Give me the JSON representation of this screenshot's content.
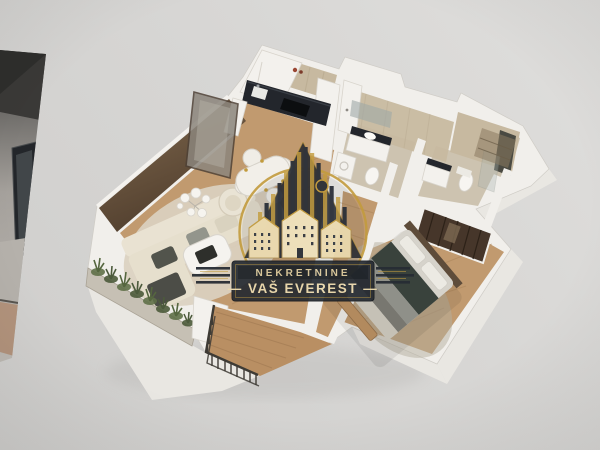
{
  "watermark": {
    "line1": "NEKRETNINE",
    "line2": "— VAŠ EVEREST —"
  },
  "scene_icons": {
    "floor_plan": "isometric-apartment-floorplan",
    "logo": "buildings-emblem-in-gold-ring"
  },
  "colors": {
    "bg_dark": "#cfcecc",
    "bg_light": "#dedddb",
    "wall": "#f1efeb",
    "wall_face": "#e9e7e2",
    "wall_shade": "#d8d5cf",
    "wood": "#c19a6f",
    "wood_dark": "#b08a5e",
    "plank": "#a37c52",
    "rug": "#dbd1c0",
    "tile_floor": "#cdc3b0",
    "tile_wall": "#c7b9a0",
    "counter_dark": "#23262c",
    "accent_wall": "#6a553f",
    "sofa_cream": "#e6dfcd",
    "cushion_dark": "#52544c",
    "cushion_gray": "#93958c",
    "plant_green": "#5f7048",
    "plant_dark": "#4b5a3a",
    "railing_dark": "#3e3b35",
    "deck_wood": "#b98f63",
    "bed_dark": "#39423c",
    "bed_gray": "#8f9089",
    "wardrobe_wood": "#46362a",
    "logo_gold": "#c29b3d",
    "logo_cream": "#ead9ae",
    "logo_banner": "#242930",
    "logo_text": "#d9c89c",
    "sliver_dark": "#3a3937",
    "sliver_wall": "#9b9894",
    "sliver_floor": "#b2937c"
  }
}
